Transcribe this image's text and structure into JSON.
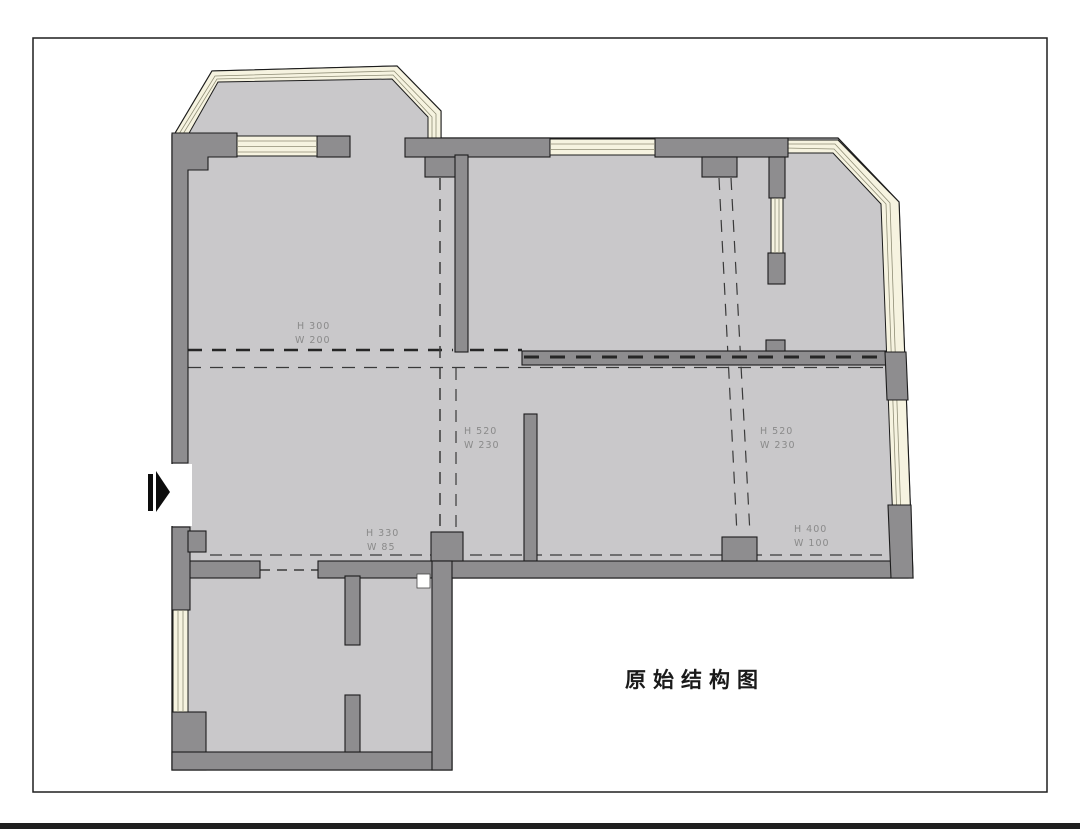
{
  "title": "原始结构图",
  "colors": {
    "paper": "#ffffff",
    "frame": "#1f1f1f",
    "floor": "#c9c8ca",
    "wall": "#8e8d8f",
    "outline": "#1c1c1c",
    "window": "#f6f3e0",
    "glaze": "#8f8d76",
    "dash": "#3a3a3a",
    "beam_dash": "#262626",
    "annotation": "#8a8a8a",
    "title_color": "#1a1a1a",
    "arrow": "#0d0d0d"
  },
  "annotations": [
    {
      "h": "H 300",
      "w": "W 200"
    },
    {
      "h": "H 520",
      "w": "W 230"
    },
    {
      "h": "H 520",
      "w": "W 230"
    },
    {
      "h": "H 330",
      "w": "W 85"
    },
    {
      "h": "H 400",
      "w": "W 100"
    }
  ]
}
